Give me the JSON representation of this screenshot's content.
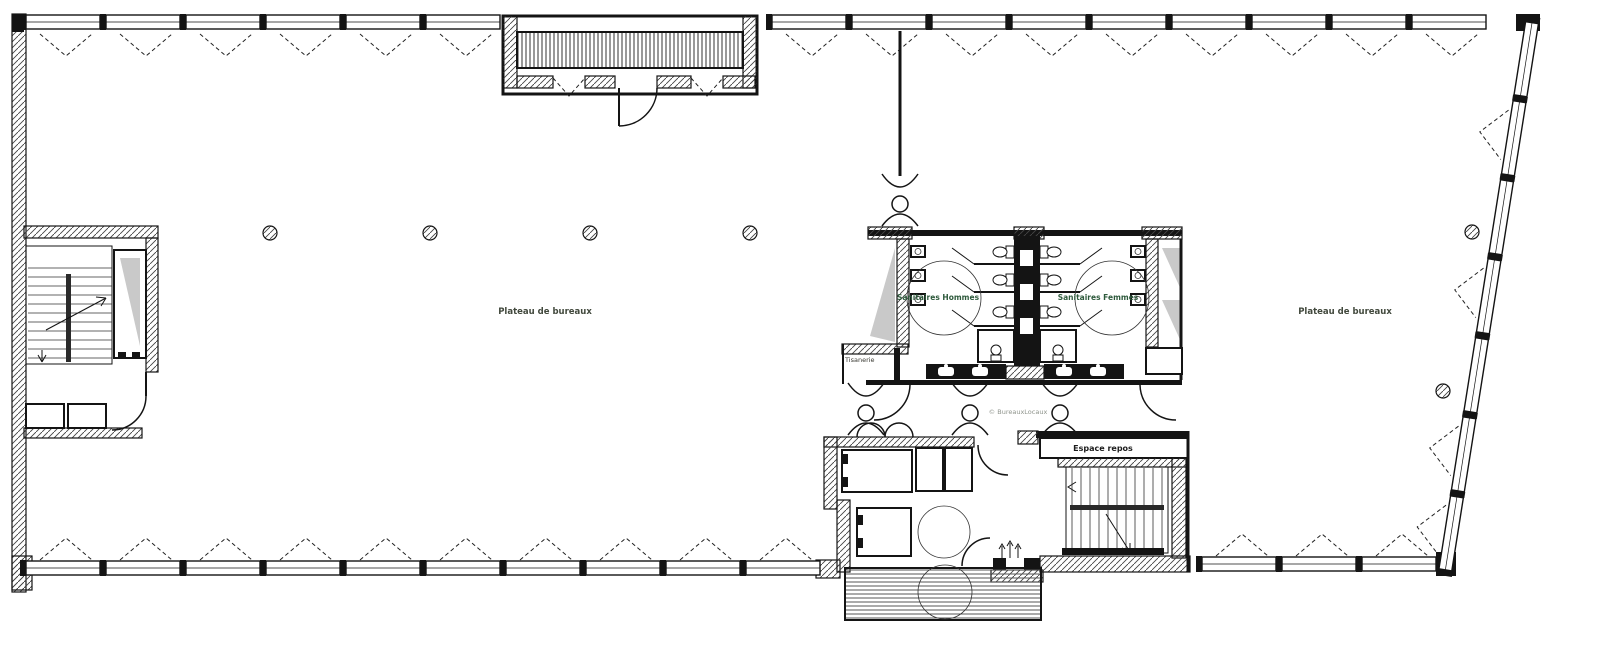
{
  "plan": {
    "labels": {
      "office_left": "Plateau de bureaux",
      "office_right": "Plateau de bureaux",
      "sanitaires_hommes": "Sanitaires Hommes",
      "sanitaires_femmes": "Sanitaires Femmes",
      "tisanerie": "Tisanerie",
      "espace_repos": "Espace repos",
      "watermark": "© BureauxLocaux"
    },
    "colors": {
      "label_office": "#42493d",
      "label_sanitaires": "#2e5a3c",
      "label_room": "#1c1c1c",
      "label_small": "#3a3a33",
      "watermark_gray": "#8f948c",
      "wall": "#141414",
      "shade": "#c9c9c9"
    }
  }
}
